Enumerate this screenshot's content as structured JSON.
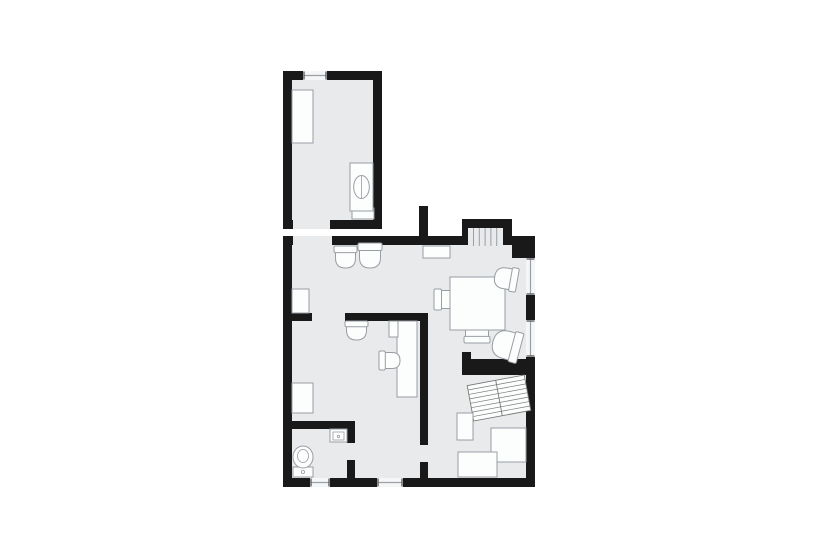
{
  "scene": {
    "width": 820,
    "height": 554,
    "bg": "#ffffff",
    "label": "residential-floor-plan"
  },
  "palette": {
    "wall": "#191919",
    "floor": "#e8eaec",
    "fill": "#fcfdfd",
    "stroke": "#999ea4",
    "window_fill": "#f5f6f7",
    "window_line": "#9aa0a6",
    "tick": "#4a4a4a",
    "hatch": "#7a7a7a"
  },
  "wall_blocks": [
    {
      "name": "upper-room-shell",
      "r": [
        283,
        71,
        99,
        158
      ]
    },
    {
      "name": "main-top-stub",
      "r": [
        419,
        206,
        9,
        30
      ]
    },
    {
      "name": "stair-niche-shell",
      "r": [
        462,
        219,
        50,
        17
      ]
    },
    {
      "name": "main-shell",
      "r": [
        283,
        236,
        252,
        251
      ]
    }
  ],
  "floors": [
    {
      "name": "upper-room-floor",
      "r": [
        292,
        80,
        81,
        140
      ]
    },
    {
      "name": "main-floor",
      "r": [
        292,
        245,
        234,
        233
      ]
    },
    {
      "name": "stair-niche-floor",
      "r": [
        468,
        228,
        35,
        19
      ]
    }
  ],
  "door_openings": [
    {
      "name": "upper-room-door-opening",
      "r": [
        293,
        220,
        37,
        9
      ]
    },
    {
      "name": "main-entry-opening",
      "r": [
        293,
        236,
        39,
        9
      ]
    },
    {
      "name": "office-doorway-opening",
      "r": [
        312,
        313,
        33,
        8
      ]
    }
  ],
  "inner_walls": [
    {
      "name": "divider-wall-left",
      "r": [
        283,
        313,
        29,
        8
      ]
    },
    {
      "name": "divider-wall-right",
      "r": [
        345,
        313,
        83,
        8
      ]
    },
    {
      "name": "office-right-wall",
      "r": [
        420,
        313,
        8,
        132
      ]
    },
    {
      "name": "office-right-wall-stub",
      "r": [
        420,
        462,
        8,
        16
      ]
    },
    {
      "name": "wc-top-wall",
      "r": [
        292,
        421,
        63,
        8
      ]
    },
    {
      "name": "wc-door-stub-upper",
      "r": [
        347,
        421,
        8,
        22
      ]
    },
    {
      "name": "wc-door-stub-lower",
      "r": [
        347,
        460,
        8,
        18
      ]
    },
    {
      "name": "stair-hall-wall",
      "r": [
        462,
        359,
        73,
        16
      ]
    },
    {
      "name": "stair-hall-wall-notch",
      "r": [
        462,
        352,
        9,
        7
      ]
    },
    {
      "name": "top-right-corner-block",
      "r": [
        512,
        236,
        23,
        22
      ]
    }
  ],
  "windows": [
    {
      "name": "window-upper-room-top",
      "r": [
        303,
        71,
        24,
        9
      ],
      "orient": "h"
    },
    {
      "name": "window-right-1",
      "r": [
        526,
        258,
        9,
        37
      ],
      "orient": "v"
    },
    {
      "name": "window-right-2",
      "r": [
        526,
        320,
        9,
        37
      ],
      "orient": "v"
    },
    {
      "name": "window-bottom-1",
      "r": [
        310,
        478,
        20,
        9
      ],
      "orient": "h"
    },
    {
      "name": "window-bottom-2",
      "r": [
        377,
        478,
        26,
        9
      ],
      "orient": "h"
    }
  ],
  "stair_niche_lines": {
    "x_start": 473.5,
    "step": 5.8,
    "count": 5,
    "y1": 228,
    "y2": 246
  },
  "furniture": [
    {
      "type": "box",
      "name": "bed",
      "r": [
        292,
        90,
        21,
        53
      ]
    },
    {
      "type": "box",
      "name": "washer-base-shelf",
      "r": [
        352,
        208,
        22,
        11
      ]
    },
    {
      "type": "washer",
      "name": "washing-machine",
      "r": [
        350,
        163,
        23,
        48
      ]
    },
    {
      "type": "chair",
      "name": "lounge-chair-1",
      "r": [
        334,
        246,
        23,
        22
      ],
      "rot": 0
    },
    {
      "type": "chair",
      "name": "lounge-chair-2",
      "r": [
        358,
        243,
        24,
        25
      ],
      "rot": 0
    },
    {
      "type": "box",
      "name": "wall-shelf",
      "r": [
        423,
        246,
        27,
        12
      ]
    },
    {
      "type": "chair",
      "name": "dining-chair-left",
      "r": [
        436,
        287,
        21,
        25
      ],
      "rot": 270
    },
    {
      "type": "chair",
      "name": "dining-chair-bottom",
      "r": [
        464,
        321,
        26,
        22
      ],
      "rot": 180
    },
    {
      "type": "box",
      "name": "dining-table",
      "r": [
        450,
        277,
        55,
        53
      ]
    },
    {
      "type": "chair",
      "name": "window-chair-upper",
      "r": [
        494,
        267,
        24,
        23
      ],
      "rot": 100
    },
    {
      "type": "chair",
      "name": "window-chair-lower",
      "r": [
        491,
        331,
        31,
        28
      ],
      "rot": 105
    },
    {
      "type": "box",
      "name": "cabinet-left-upper",
      "r": [
        292,
        289,
        17,
        24
      ]
    },
    {
      "type": "chair",
      "name": "office-wall-chair",
      "r": [
        345,
        321,
        23,
        19
      ],
      "rot": 0
    },
    {
      "type": "box",
      "name": "desk",
      "r": [
        397,
        321,
        20,
        76
      ]
    },
    {
      "type": "box",
      "name": "desk-accessory",
      "r": [
        389,
        321,
        9,
        16
      ]
    },
    {
      "type": "chair",
      "name": "desk-chair",
      "r": [
        380,
        350,
        19,
        21
      ],
      "rot": 270
    },
    {
      "type": "box",
      "name": "cabinet-left-lower",
      "r": [
        292,
        383,
        21,
        30
      ]
    },
    {
      "type": "toilet",
      "name": "toilet",
      "cx": 303,
      "cy": 457,
      "rx": 10,
      "ry": 11,
      "tank": [
        293,
        467,
        20,
        10
      ]
    },
    {
      "type": "sink",
      "name": "sink",
      "r": [
        330,
        429,
        17,
        13
      ]
    },
    {
      "type": "stairs",
      "name": "staircase",
      "cx": 499,
      "cy": 398,
      "w": 58,
      "h": 36,
      "rot": -10.5,
      "steps": 7
    },
    {
      "type": "box",
      "name": "hall-shelf",
      "r": [
        457,
        413,
        16,
        27
      ]
    },
    {
      "type": "box",
      "name": "counter-right",
      "r": [
        491,
        428,
        35,
        34
      ]
    },
    {
      "type": "box",
      "name": "counter-bottom",
      "r": [
        458,
        452,
        39,
        25
      ]
    }
  ]
}
